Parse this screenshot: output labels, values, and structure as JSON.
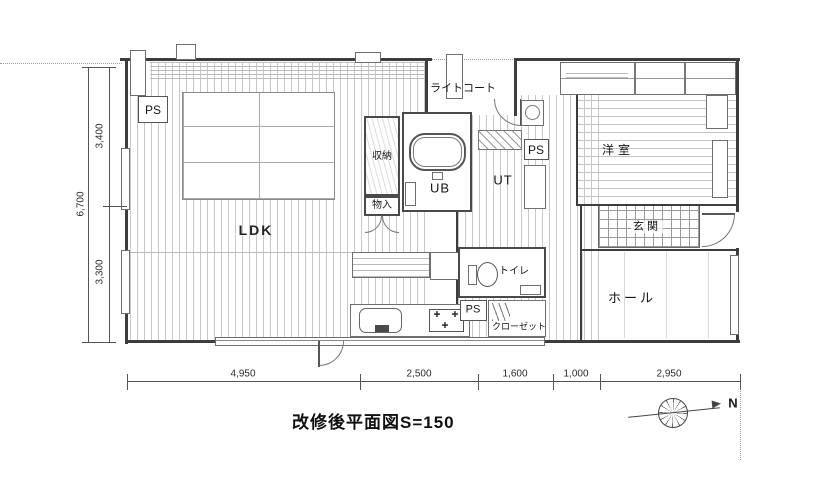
{
  "title": "改修後平面図S=150",
  "compass": {
    "north_label": "N"
  },
  "rooms": {
    "ldk": "LDK",
    "youshitsu": "洋室",
    "genkan": "玄関",
    "hall": "ホール",
    "toilet": "トイレ",
    "closet": "クローゼット",
    "shuno": "収納",
    "monoire": "物入",
    "ub": "UB",
    "ut": "UT",
    "light_court": "ライトコート",
    "ps_top": "PS",
    "ps_mid": "PS",
    "ps_low": "PS"
  },
  "dimensions": {
    "left_total": "6,700",
    "left_top": "3,400",
    "left_bottom": "3,300",
    "bottom": [
      "4,950",
      "2,500",
      "1,600",
      "1,000",
      "2,950"
    ]
  }
}
